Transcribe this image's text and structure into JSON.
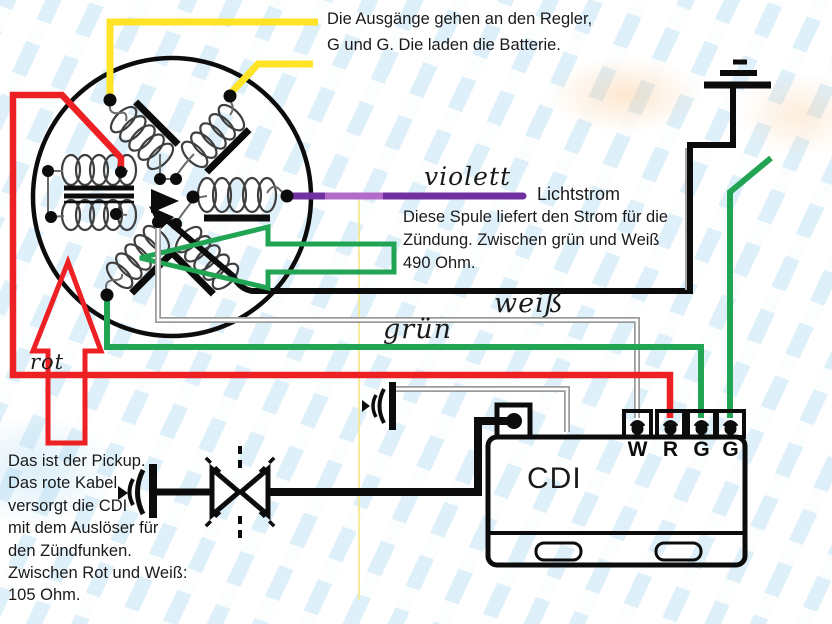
{
  "colors": {
    "yellow": "#ffe326",
    "red": "#ed2024",
    "green": "#22a455",
    "violet": "#7030a0",
    "violet_light": "#b26bc8",
    "gray_wire": "#9b9b9b",
    "black": "#0c0c0c",
    "guide_yellow": "#f6e78a"
  },
  "notes": {
    "regler_lines": [
      "Die Ausgänge gehen an den Regler,",
      "G und G. Die laden die Batterie."
    ],
    "spule_lines": [
      "Diese Spule liefert den Strom für die",
      "Zündung. Zwischen grün und Weiß",
      "490 Ohm."
    ],
    "pickup_lines": [
      "Das ist der Pickup.",
      "Das rote Kabel",
      "versorgt die CDI",
      "mit dem Auslöser für",
      "den Zündfunken.",
      "Zwischen Rot und Weiß:",
      "105 Ohm."
    ]
  },
  "wire_labels": {
    "violett": "violett",
    "lichtstrom": "Lichtstrom",
    "weiss": "weiß",
    "gruen": "grün",
    "rot": "rot"
  },
  "cdi": {
    "label": "CDI",
    "terminals": [
      "W",
      "R",
      "G",
      "G"
    ]
  },
  "icons": {
    "ground": "earth-ground-symbol",
    "spark_gap": "spark-gap-icon",
    "plug_connector": "spark-plug-connector-icon",
    "pickup_pointer": "red-up-arrow-icon",
    "spule_pointer": "green-left-arrow-icon"
  }
}
